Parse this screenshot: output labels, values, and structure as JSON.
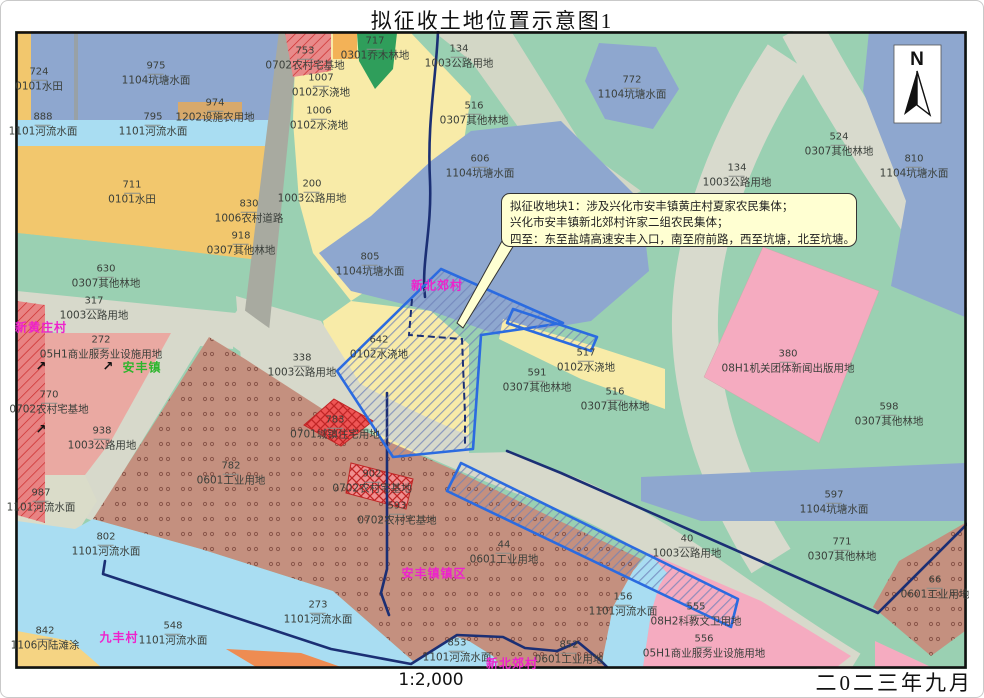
{
  "title": "拟征收土地位置示意图1",
  "footer": {
    "scale": "1:2,000",
    "date": "二0二三年九月"
  },
  "north_label": "N",
  "callout": {
    "lines": [
      "拟征收地块1：涉及兴化市安丰镇黄庄村夏家农民集体；",
      "兴化市安丰镇新北郊村许家二组农民集体；",
      "四至：东至盐靖高速安丰入口，南至府前路，西至坑塘，北至坑塘。"
    ]
  },
  "colors": {
    "village_magenta": "#ee22cc",
    "town_green": "#2db52d",
    "boundary_navy": "#1b2f74",
    "parcel_blue": "#2b6be0",
    "pond_blue": "#8ea7cf",
    "river_blue": "#a9ddf2",
    "paddy_orange": "#f2c76d",
    "irrigated_yellow": "#f8eba8",
    "forest_green": "#9ad0b2",
    "road_gray": "#d7d9cb",
    "industrial_brown": "#c4907f",
    "pink_parcel": "#f5abc0",
    "salmon": "#eaa9a2",
    "callout_yellow": "#ffffd2"
  },
  "icons": {
    "ne_arrow": "↗"
  },
  "map": {
    "villages": [
      {
        "name": "新黄庄村",
        "x": 40,
        "y": 326,
        "color": "#ee22cc"
      },
      {
        "name": "安丰镇",
        "x": 141,
        "y": 366,
        "color": "#2db52d"
      },
      {
        "name": "新北郊村",
        "x": 436,
        "y": 284,
        "color": "#ee22cc"
      },
      {
        "name": "安丰镇镇区",
        "x": 433,
        "y": 572,
        "color": "#ee22cc"
      },
      {
        "name": "九丰村",
        "x": 118,
        "y": 636,
        "color": "#ee22cc"
      },
      {
        "name": "新北郊村",
        "x": 511,
        "y": 662,
        "color": "#ee22cc"
      }
    ],
    "arrows": [
      {
        "x": 40,
        "y": 366
      },
      {
        "x": 107,
        "y": 366
      },
      {
        "x": 40,
        "y": 429
      }
    ],
    "parcels": [
      {
        "num": "724",
        "type": "0101水田",
        "x": 38,
        "y": 79
      },
      {
        "num": "975",
        "type": "1104坑塘水面",
        "x": 155,
        "y": 73
      },
      {
        "num": "974",
        "type": "1202设施农用地",
        "x": 214,
        "y": 110
      },
      {
        "num": "888",
        "type": "1101河流水面",
        "x": 42,
        "y": 124
      },
      {
        "num": "795",
        "type": "1101河流水面",
        "x": 152,
        "y": 124
      },
      {
        "num": "711",
        "type": "0101水田",
        "x": 131,
        "y": 192
      },
      {
        "num": "753",
        "type": "0702农村宅基地",
        "x": 304,
        "y": 58
      },
      {
        "num": "717",
        "type": "0301乔木林地",
        "x": 374,
        "y": 48
      },
      {
        "num": "1007",
        "type": "0102水浇地",
        "x": 320,
        "y": 85
      },
      {
        "num": "1006",
        "type": "0102水浇地",
        "x": 318,
        "y": 118
      },
      {
        "num": "134",
        "type": "1003公路用地",
        "x": 458,
        "y": 56
      },
      {
        "num": "516",
        "type": "0307其他林地",
        "x": 473,
        "y": 113
      },
      {
        "num": "606",
        "type": "1104坑塘水面",
        "x": 479,
        "y": 166
      },
      {
        "num": "772",
        "type": "1104坑塘水面",
        "x": 631,
        "y": 87
      },
      {
        "num": "524",
        "type": "0307其他林地",
        "x": 838,
        "y": 144
      },
      {
        "num": "134",
        "type": "1003公路用地",
        "x": 736,
        "y": 175
      },
      {
        "num": "810",
        "type": "1104坑塘水面",
        "x": 913,
        "y": 166
      },
      {
        "num": "200",
        "type": "1003公路用地",
        "x": 311,
        "y": 191
      },
      {
        "num": "830",
        "type": "1006农村道路",
        "x": 248,
        "y": 211
      },
      {
        "num": "918",
        "type": "0307其他林地",
        "x": 240,
        "y": 243
      },
      {
        "num": "630",
        "type": "0307其他林地",
        "x": 105,
        "y": 276
      },
      {
        "num": "317",
        "type": "1003公路用地",
        "x": 93,
        "y": 308
      },
      {
        "num": "272",
        "type": "05H1商业服务业设施用地",
        "x": 100,
        "y": 347
      },
      {
        "num": "770",
        "type": "0702农村宅基地",
        "x": 48,
        "y": 402
      },
      {
        "num": "938",
        "type": "1003公路用地",
        "x": 101,
        "y": 438
      },
      {
        "num": "782",
        "type": "0601工业用地",
        "x": 230,
        "y": 473
      },
      {
        "num": "987",
        "type": "1101河流水面",
        "x": 40,
        "y": 500
      },
      {
        "num": "805",
        "type": "1104坑塘水面",
        "x": 369,
        "y": 264
      },
      {
        "num": "642",
        "type": "0102水浇地",
        "x": 378,
        "y": 347
      },
      {
        "num": "338",
        "type": "1003公路用地",
        "x": 301,
        "y": 365
      },
      {
        "num": "517",
        "type": "0102水浇地",
        "x": 585,
        "y": 360
      },
      {
        "num": "591",
        "type": "0307其他林地",
        "x": 536,
        "y": 380
      },
      {
        "num": "516",
        "type": "0307其他林地",
        "x": 614,
        "y": 399
      },
      {
        "num": "380",
        "type": "08H1机关团体新闻出版用地",
        "x": 787,
        "y": 361
      },
      {
        "num": "598",
        "type": "0307其他林地",
        "x": 888,
        "y": 414
      },
      {
        "num": "783",
        "type": "0701城镇住宅用地",
        "x": 334,
        "y": 427
      },
      {
        "num": "902",
        "type": "0702农村宅基地",
        "x": 371,
        "y": 481
      },
      {
        "num": "593",
        "type": "0702农村宅基地",
        "x": 396,
        "y": 513
      },
      {
        "num": "44",
        "type": "0601工业用地",
        "x": 503,
        "y": 552
      },
      {
        "num": "802",
        "type": "1101河流水面",
        "x": 105,
        "y": 544
      },
      {
        "num": "842",
        "type": "1106内陆滩涂",
        "x": 44,
        "y": 638
      },
      {
        "num": "548",
        "type": "1101河流水面",
        "x": 172,
        "y": 633
      },
      {
        "num": "273",
        "type": "1101河流水面",
        "x": 317,
        "y": 612
      },
      {
        "num": "853",
        "type": "1101河流水面",
        "x": 456,
        "y": 650
      },
      {
        "num": "852",
        "type": "0601工业用地",
        "x": 568,
        "y": 652
      },
      {
        "num": "156",
        "type": "1101河流水面",
        "x": 622,
        "y": 604
      },
      {
        "num": "555",
        "type": "08H2科教文卫用地",
        "x": 695,
        "y": 614
      },
      {
        "num": "556",
        "type": "05H1商业服务业设施用地",
        "x": 703,
        "y": 646
      },
      {
        "num": "597",
        "type": "1104坑塘水面",
        "x": 833,
        "y": 502
      },
      {
        "num": "40",
        "type": "1003公路用地",
        "x": 686,
        "y": 546
      },
      {
        "num": "771",
        "type": "0307其他林地",
        "x": 841,
        "y": 549
      },
      {
        "num": "66",
        "type": "0601工业用地",
        "x": 934,
        "y": 587
      }
    ]
  }
}
